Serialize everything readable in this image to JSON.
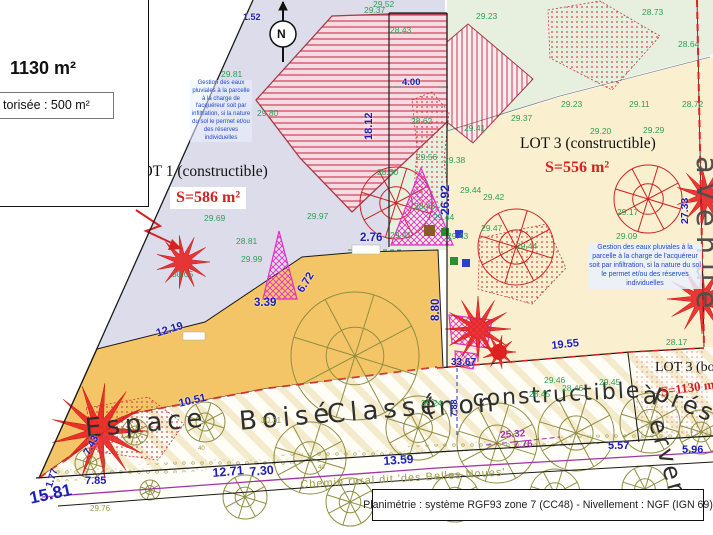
{
  "title_block": {
    "area": "1130 m²",
    "authorized": "torisée : 500 m²"
  },
  "footer": {
    "text": "Planimétrie : système RGF93 zone 7 (CC48) - Nivellement : NGF (IGN 69)"
  },
  "compass": {
    "label": "N"
  },
  "lots": {
    "lot1": {
      "name": "LOT 1 (constructible)",
      "area": "S=586 m²"
    },
    "lot3": {
      "name": "LOT 3 (constructible)",
      "area": "S=556 m²"
    },
    "lot3_wooded": {
      "name": "LOT 3 (boisé)",
      "area": "S=1130 m²"
    }
  },
  "notes": {
    "stormwater": "Gestion des eaux pluviales à la parcelle à la charge de l'acquéreur soit par infiltration, si la nature du sol le permet et/ou des réserves individuelles"
  },
  "road_label": "Chemin rural dit 'des Belles Noues'",
  "street_label": "avenue",
  "colors": {
    "lot1_fill": "#dcdcea",
    "lot3_fill": "#faf0cf",
    "green_fill": "#e7f0df",
    "path_fill": "#f4c566",
    "dimension_blue": "#1c1cb8",
    "elevation_green": "#2f9e55",
    "area_red": "#d42222",
    "pylon_magenta": "#e231c9",
    "purple_line": "#a033aa"
  },
  "labels": [
    {
      "t": "29.52",
      "x": 373,
      "y": 0,
      "cls": "g"
    },
    {
      "t": "29.37",
      "x": 364,
      "y": 6,
      "cls": "g"
    },
    {
      "t": "28.43",
      "x": 390,
      "y": 26,
      "cls": "g"
    },
    {
      "t": "29.23",
      "x": 476,
      "y": 12,
      "cls": "g"
    },
    {
      "t": "28.73",
      "x": 642,
      "y": 8,
      "cls": "g"
    },
    {
      "t": "28.64",
      "x": 678,
      "y": 40,
      "cls": "g"
    },
    {
      "t": "29.23",
      "x": 561,
      "y": 100,
      "cls": "g"
    },
    {
      "t": "29.11",
      "x": 629,
      "y": 100,
      "cls": "g"
    },
    {
      "t": "28.72",
      "x": 682,
      "y": 100,
      "cls": "g"
    },
    {
      "t": "29.37",
      "x": 511,
      "y": 114,
      "cls": "g"
    },
    {
      "t": "29.41",
      "x": 464,
      "y": 124,
      "cls": "g"
    },
    {
      "t": "28.62",
      "x": 411,
      "y": 117,
      "cls": "g"
    },
    {
      "t": "29.20",
      "x": 590,
      "y": 127,
      "cls": "g"
    },
    {
      "t": "29.29",
      "x": 643,
      "y": 126,
      "cls": "g"
    },
    {
      "t": "29.80",
      "x": 257,
      "y": 109,
      "cls": "g"
    },
    {
      "t": "29.81",
      "x": 221,
      "y": 70,
      "cls": "g"
    },
    {
      "t": "28.30",
      "x": 377,
      "y": 168,
      "cls": "g"
    },
    {
      "t": "29.56",
      "x": 416,
      "y": 153,
      "cls": "g"
    },
    {
      "t": "29.38",
      "x": 444,
      "y": 156,
      "cls": "g"
    },
    {
      "t": "28.43",
      "x": 414,
      "y": 202,
      "cls": "g"
    },
    {
      "t": "29.44",
      "x": 433,
      "y": 213,
      "cls": "g"
    },
    {
      "t": "29.69",
      "x": 204,
      "y": 214,
      "cls": "g"
    },
    {
      "t": "29.97",
      "x": 307,
      "y": 212,
      "cls": "g"
    },
    {
      "t": "29.17",
      "x": 617,
      "y": 208,
      "cls": "g"
    },
    {
      "t": "28.81",
      "x": 236,
      "y": 237,
      "cls": "g"
    },
    {
      "t": "29.99",
      "x": 241,
      "y": 255,
      "cls": "g"
    },
    {
      "t": "30.05",
      "x": 172,
      "y": 270,
      "cls": "g"
    },
    {
      "t": "29.44",
      "x": 460,
      "y": 186,
      "cls": "g"
    },
    {
      "t": "29.42",
      "x": 483,
      "y": 193,
      "cls": "g"
    },
    {
      "t": "29.43",
      "x": 447,
      "y": 232,
      "cls": "g"
    },
    {
      "t": "29.41",
      "x": 390,
      "y": 231,
      "cls": "g"
    },
    {
      "t": "29.47",
      "x": 481,
      "y": 224,
      "cls": "g"
    },
    {
      "t": "29.09",
      "x": 616,
      "y": 232,
      "cls": "g"
    },
    {
      "t": "29.44",
      "x": 516,
      "y": 242,
      "cls": "g"
    },
    {
      "t": "28.17",
      "x": 666,
      "y": 338,
      "cls": "g"
    },
    {
      "t": "29.24",
      "x": 421,
      "y": 399,
      "cls": "g"
    },
    {
      "t": "29.46",
      "x": 544,
      "y": 376,
      "cls": "g"
    },
    {
      "t": "29.45",
      "x": 599,
      "y": 378,
      "cls": "g"
    },
    {
      "t": "28.45",
      "x": 529,
      "y": 390,
      "cls": "g"
    },
    {
      "t": "28.46",
      "x": 562,
      "y": 384,
      "cls": "g"
    },
    {
      "t": "29.76",
      "x": 90,
      "y": 505,
      "cls": "o"
    },
    {
      "t": "30.31",
      "x": 261,
      "y": 417,
      "cls": "o"
    },
    {
      "t": "40",
      "x": 198,
      "y": 446,
      "cls": "o",
      "fs": 6
    },
    {
      "t": "40",
      "x": 318,
      "y": 465,
      "cls": "o",
      "fs": 6
    },
    {
      "t": "1.52",
      "x": 243,
      "y": 13,
      "cls": "b",
      "fs": 9
    },
    {
      "t": "4.00",
      "x": 402,
      "y": 78,
      "cls": "b",
      "fs": 9.5
    },
    {
      "t": "18.12",
      "x": 364,
      "y": 140,
      "cls": "b",
      "r": -90,
      "fs": 11
    },
    {
      "t": "26.92",
      "x": 439,
      "y": 215,
      "cls": "b",
      "r": -90,
      "fs": 12
    },
    {
      "t": "27.33",
      "x": 680,
      "y": 224,
      "cls": "b",
      "r": -90,
      "fs": 10.5
    },
    {
      "t": "2.76",
      "x": 360,
      "y": 233,
      "cls": "b",
      "fs": 11.5
    },
    {
      "t": "6.72",
      "x": 296,
      "y": 289,
      "cls": "b",
      "r": -58,
      "fs": 11
    },
    {
      "t": "8.80",
      "x": 431,
      "y": 321,
      "cls": "b",
      "r": -90,
      "fs": 11.5
    },
    {
      "t": "3.39",
      "x": 254,
      "y": 298,
      "cls": "b",
      "fs": 11.5
    },
    {
      "t": "12.19",
      "x": 155,
      "y": 329,
      "cls": "b",
      "r": -17,
      "fs": 11
    },
    {
      "t": "10.51",
      "x": 178,
      "y": 399,
      "cls": "b",
      "r": -13,
      "fs": 11
    },
    {
      "t": "19.55",
      "x": 551,
      "y": 341,
      "cls": "b",
      "r": -6,
      "fs": 11
    },
    {
      "t": "33.67",
      "x": 451,
      "y": 358,
      "cls": "b",
      "fs": 10
    },
    {
      "t": "7.88",
      "x": 450,
      "y": 417,
      "cls": "b",
      "r": -90,
      "fs": 9
    },
    {
      "t": "7.85",
      "x": 85,
      "y": 476,
      "cls": "b",
      "fs": 11
    },
    {
      "t": "7.43",
      "x": 82,
      "y": 452,
      "cls": "b",
      "r": -62,
      "fs": 10.5
    },
    {
      "t": "1.77",
      "x": 45,
      "y": 486,
      "cls": "b",
      "r": -72,
      "fs": 10
    },
    {
      "t": "15.81",
      "x": 28,
      "y": 490,
      "cls": "b",
      "r": -12,
      "fs": 17
    },
    {
      "t": "12.71",
      "x": 212,
      "y": 467,
      "cls": "b",
      "r": -5,
      "fs": 12.5
    },
    {
      "t": "7.30",
      "x": 249,
      "y": 466,
      "cls": "b",
      "r": -5,
      "fs": 12.5
    },
    {
      "t": "13.59",
      "x": 383,
      "y": 455,
      "cls": "b",
      "r": -4,
      "fs": 12
    },
    {
      "t": "5.57",
      "x": 608,
      "y": 441,
      "cls": "b",
      "fs": 11
    },
    {
      "t": "5.96",
      "x": 682,
      "y": 445,
      "cls": "b",
      "fs": 11
    },
    {
      "t": "25.32",
      "x": 500,
      "y": 431,
      "cls": "p",
      "r": -4
    },
    {
      "t": "7.76",
      "x": 513,
      "y": 441,
      "cls": "p",
      "r": -4
    },
    {
      "t": "Espace",
      "x": 84,
      "y": 416,
      "cls": "e",
      "r": -5,
      "fs": 26,
      "ls": 5
    },
    {
      "t": "Boisé",
      "x": 238,
      "y": 409,
      "cls": "e",
      "r": -5,
      "fs": 26,
      "ls": 5
    },
    {
      "t": "Classé",
      "x": 326,
      "y": 402,
      "cls": "e",
      "r": -5,
      "fs": 26,
      "ls": 5
    },
    {
      "t": "(non",
      "x": 424,
      "y": 395,
      "cls": "e",
      "r": -4,
      "fs": 25,
      "ls": 4
    },
    {
      "t": "constructible",
      "x": 472,
      "y": 389,
      "cls": "e",
      "r": -3,
      "fs": 22,
      "ls": 2
    },
    {
      "t": "à",
      "x": 642,
      "y": 384,
      "cls": "e",
      "r": -3,
      "fs": 24
    },
    {
      "t": "prés",
      "x": 660,
      "y": 380,
      "cls": "e",
      "r": 22,
      "fs": 24,
      "ls": 3
    },
    {
      "t": "erver",
      "x": 668,
      "y": 416,
      "cls": "e",
      "r": 74,
      "fs": 24,
      "ls": 3
    }
  ]
}
